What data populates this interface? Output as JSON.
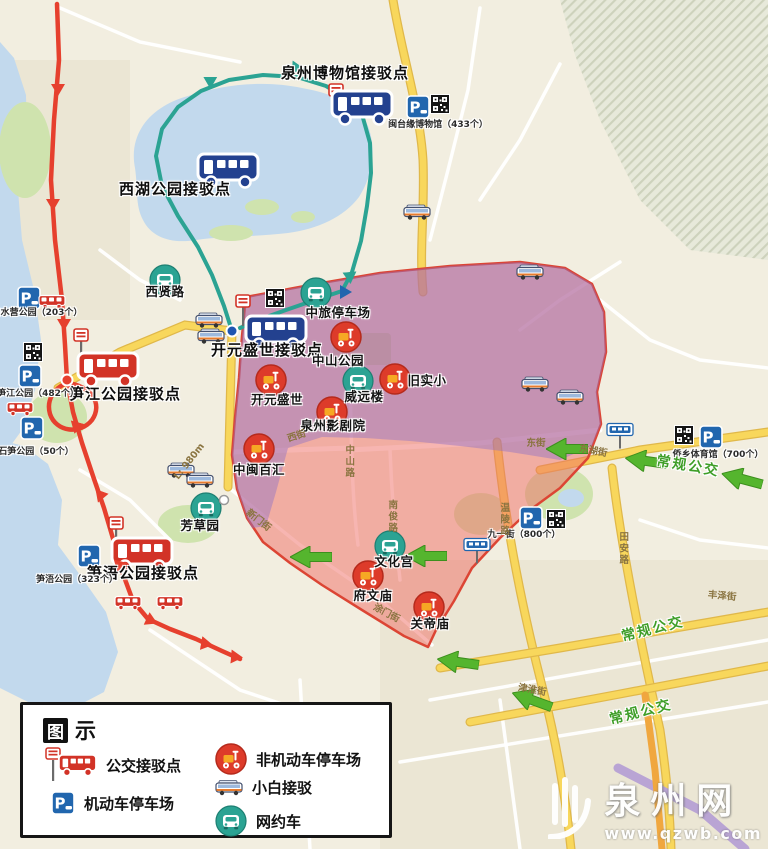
{
  "colors": {
    "land": "#f2eee0",
    "water": "#c2d9ed",
    "park": "#cfe3ae",
    "arterial": "#f8d75c",
    "arterial_casing": "#e0b84a",
    "zone_pink": "rgba(239,108,100,0.5)",
    "zone_border": "#dc4534",
    "zone_purple": "rgba(144,114,198,0.45)",
    "route_shuttle": "#2ba393",
    "route_red": "#e6402e",
    "bus_green": "#3f9e28",
    "parking_blue": "#2166ae",
    "scooter_red": "#dd3b2a",
    "netcar_teal": "#2ba393",
    "bus_blue": "#23418f",
    "bus_red": "#d23327",
    "arrow_green": "#55b52e"
  },
  "legend": {
    "title_box": "图",
    "title_rest": "示",
    "items": [
      {
        "label": "公交接驳点",
        "icon": "bus-shuttle-point"
      },
      {
        "label": "机动车停车场",
        "icon": "motor-parking"
      },
      {
        "label": "非机动车停车场",
        "icon": "non-motor-parking"
      },
      {
        "label": "小白接驳",
        "icon": "xiaobai-shuttle"
      },
      {
        "label": "网约车",
        "icon": "ride-hailing"
      }
    ]
  },
  "watermark": {
    "site": "泉州网",
    "url": "www.qzwb.com"
  },
  "map": {
    "labels": [
      {
        "text": "泉州博物馆接驳点",
        "x": 345,
        "y": 73,
        "cls": "pt"
      },
      {
        "text": "西湖公园接驳点",
        "x": 175,
        "y": 189,
        "cls": "pt"
      },
      {
        "text": "开元盛世接驳点",
        "x": 267,
        "y": 350,
        "cls": "pt"
      },
      {
        "text": "笋江公园接驳点",
        "x": 125,
        "y": 394,
        "cls": "pt"
      },
      {
        "text": "笋浯公园接驳点",
        "x": 143,
        "y": 573,
        "cls": "pt"
      },
      {
        "text": "中旅停车场",
        "x": 338,
        "y": 313,
        "cls": "poi"
      },
      {
        "text": "中山公园",
        "x": 338,
        "y": 361,
        "cls": "poi"
      },
      {
        "text": "旧实小",
        "x": 427,
        "y": 381,
        "cls": "poi"
      },
      {
        "text": "威远楼",
        "x": 364,
        "y": 397,
        "cls": "poi"
      },
      {
        "text": "开元盛世",
        "x": 277,
        "y": 400,
        "cls": "poi"
      },
      {
        "text": "泉州影剧院",
        "x": 333,
        "y": 426,
        "cls": "poi"
      },
      {
        "text": "中闽百汇",
        "x": 259,
        "y": 470,
        "cls": "poi"
      },
      {
        "text": "芳草园",
        "x": 200,
        "y": 526,
        "cls": "poi"
      },
      {
        "text": "文化宫",
        "x": 394,
        "y": 562,
        "cls": "poi"
      },
      {
        "text": "府文庙",
        "x": 373,
        "y": 596,
        "cls": "poi"
      },
      {
        "text": "关帝庙",
        "x": 430,
        "y": 624,
        "cls": "poi"
      },
      {
        "text": "西贤路",
        "x": 165,
        "y": 292,
        "cls": "poi"
      },
      {
        "text": "闽台缘博物馆（433个）",
        "x": 438,
        "y": 126,
        "cls": "park-lbl"
      },
      {
        "text": "白水营公园（203个）",
        "x": 37,
        "y": 314,
        "cls": "park-lbl"
      },
      {
        "text": "笋江公园（482个）",
        "x": 38,
        "y": 395,
        "cls": "park-lbl"
      },
      {
        "text": "石笋公园（50个）",
        "x": 36,
        "y": 453,
        "cls": "park-lbl"
      },
      {
        "text": "笋浯公园（323个）",
        "x": 77,
        "y": 581,
        "cls": "park-lbl"
      },
      {
        "text": "九一街（800个）",
        "x": 524,
        "y": 536,
        "cls": "park-lbl"
      },
      {
        "text": "侨乡体育馆（700个）",
        "x": 718,
        "y": 456,
        "cls": "park-lbl"
      },
      {
        "text": "西街",
        "x": 297,
        "y": 437,
        "cls": "road",
        "rot": -18
      },
      {
        "text": "东街",
        "x": 536,
        "y": 444,
        "cls": "road"
      },
      {
        "text": "东湖街",
        "x": 593,
        "y": 452,
        "cls": "road",
        "rot": 10
      },
      {
        "text": "津淮街",
        "x": 532,
        "y": 691,
        "cls": "road",
        "rot": 10
      },
      {
        "text": "丰泽街",
        "x": 722,
        "y": 597,
        "cls": "road",
        "rot": 5
      },
      {
        "text": "新门街",
        "x": 258,
        "y": 521,
        "cls": "road",
        "rot": 38
      },
      {
        "text": "涂门街",
        "x": 386,
        "y": 614,
        "cls": "road",
        "rot": 28
      },
      {
        "text": "L: 980m",
        "x": 190,
        "y": 462,
        "cls": "road",
        "rot": -52
      },
      {
        "text": "中山路",
        "x": 348,
        "y": 462,
        "cls": "roadv"
      },
      {
        "text": "南俊路",
        "x": 391,
        "y": 517,
        "cls": "roadv"
      },
      {
        "text": "温陵路",
        "x": 503,
        "y": 520,
        "cls": "roadv"
      },
      {
        "text": "田安路",
        "x": 622,
        "y": 549,
        "cls": "roadv"
      },
      {
        "text": "常规公交",
        "x": 688,
        "y": 467,
        "cls": "buslbl",
        "rot": 10
      },
      {
        "text": "常规公交",
        "x": 653,
        "y": 630,
        "cls": "buslbl",
        "rot": -14
      },
      {
        "text": "常规公交",
        "x": 641,
        "y": 713,
        "cls": "buslbl",
        "rot": -14
      }
    ],
    "markers": [
      {
        "t": "busstop",
        "x": 336,
        "y": 100
      },
      {
        "t": "bus_blue",
        "x": 362,
        "y": 107
      },
      {
        "t": "bus_blue",
        "x": 228,
        "y": 170
      },
      {
        "t": "busstop",
        "x": 243,
        "y": 311
      },
      {
        "t": "bus_blue",
        "x": 276,
        "y": 332
      },
      {
        "t": "dot_blue",
        "x": 232,
        "y": 331
      },
      {
        "t": "busstop",
        "x": 81,
        "y": 345
      },
      {
        "t": "bus_red",
        "x": 108,
        "y": 369
      },
      {
        "t": "dot_red",
        "x": 67,
        "y": 380
      },
      {
        "t": "busstop",
        "x": 116,
        "y": 533
      },
      {
        "t": "bus_red",
        "x": 142,
        "y": 554
      },
      {
        "t": "busstop_bus",
        "x": 620,
        "y": 436
      },
      {
        "t": "busstop_bus",
        "x": 477,
        "y": 551
      },
      {
        "t": "parking",
        "x": 418,
        "y": 107
      },
      {
        "t": "qr",
        "x": 440,
        "y": 104
      },
      {
        "t": "parking",
        "x": 29,
        "y": 298
      },
      {
        "t": "qr",
        "x": 33,
        "y": 352
      },
      {
        "t": "parking",
        "x": 30,
        "y": 376
      },
      {
        "t": "parking",
        "x": 32,
        "y": 428
      },
      {
        "t": "parking",
        "x": 89,
        "y": 556
      },
      {
        "t": "parking",
        "x": 531,
        "y": 518
      },
      {
        "t": "qr",
        "x": 556,
        "y": 519
      },
      {
        "t": "parking",
        "x": 711,
        "y": 437
      },
      {
        "t": "qr",
        "x": 684,
        "y": 435
      },
      {
        "t": "qr",
        "x": 275,
        "y": 298
      },
      {
        "t": "minibus",
        "x": 209,
        "y": 320
      },
      {
        "t": "minibus",
        "x": 211,
        "y": 336
      },
      {
        "t": "minibus",
        "x": 181,
        "y": 470
      },
      {
        "t": "minibus",
        "x": 200,
        "y": 480
      },
      {
        "t": "minibus",
        "x": 417,
        "y": 212
      },
      {
        "t": "minibus",
        "x": 530,
        "y": 272
      },
      {
        "t": "minibus",
        "x": 535,
        "y": 384
      },
      {
        "t": "minibus",
        "x": 570,
        "y": 397
      },
      {
        "t": "minired",
        "x": 52,
        "y": 301
      },
      {
        "t": "minired",
        "x": 20,
        "y": 408
      },
      {
        "t": "minired",
        "x": 128,
        "y": 602
      },
      {
        "t": "minired",
        "x": 170,
        "y": 602
      },
      {
        "t": "scooter",
        "x": 346,
        "y": 337
      },
      {
        "t": "scooter",
        "x": 271,
        "y": 380
      },
      {
        "t": "scooter",
        "x": 395,
        "y": 379
      },
      {
        "t": "scooter",
        "x": 332,
        "y": 412
      },
      {
        "t": "scooter",
        "x": 259,
        "y": 449
      },
      {
        "t": "scooter",
        "x": 368,
        "y": 576
      },
      {
        "t": "scooter",
        "x": 429,
        "y": 607
      },
      {
        "t": "netcar",
        "x": 165,
        "y": 280
      },
      {
        "t": "netcar",
        "x": 316,
        "y": 293
      },
      {
        "t": "netcar",
        "x": 358,
        "y": 381
      },
      {
        "t": "netcar",
        "x": 390,
        "y": 546
      },
      {
        "t": "netcar",
        "x": 206,
        "y": 508
      },
      {
        "t": "dot_white",
        "x": 224,
        "y": 500
      },
      {
        "t": "arrow",
        "x": 567,
        "y": 449,
        "rot": 0
      },
      {
        "t": "arrow",
        "x": 646,
        "y": 461,
        "rot": 8
      },
      {
        "t": "arrow",
        "x": 742,
        "y": 479,
        "rot": 15
      },
      {
        "t": "arrow",
        "x": 311,
        "y": 557,
        "rot": 0
      },
      {
        "t": "arrow",
        "x": 426,
        "y": 556,
        "rot": 0
      },
      {
        "t": "arrow",
        "x": 458,
        "y": 662,
        "rot": 8
      },
      {
        "t": "arrow",
        "x": 532,
        "y": 700,
        "rot": 20
      },
      {
        "t": "tri",
        "x": 212,
        "y": 80,
        "rot": 60,
        "c": "#2ba393"
      },
      {
        "t": "tri",
        "x": 298,
        "y": 68,
        "rot": 95,
        "c": "#2ba393"
      },
      {
        "t": "tri",
        "x": 350,
        "y": 278,
        "rot": 175,
        "c": "#2ba393"
      },
      {
        "t": "tri",
        "x": 346,
        "y": 292,
        "rot": 90,
        "c": "#2166ae"
      },
      {
        "t": "tri",
        "x": 58,
        "y": 90,
        "rot": 180,
        "c": "#e6402e"
      },
      {
        "t": "tri",
        "x": 53,
        "y": 205,
        "rot": 180,
        "c": "#e6402e"
      },
      {
        "t": "tri",
        "x": 64,
        "y": 325,
        "rot": 180,
        "c": "#e6402e"
      },
      {
        "t": "tri",
        "x": 76,
        "y": 428,
        "rot": 195,
        "c": "#e6402e"
      },
      {
        "t": "tri",
        "x": 100,
        "y": 497,
        "rot": 200,
        "c": "#e6402e"
      },
      {
        "t": "tri",
        "x": 119,
        "y": 567,
        "rot": 195,
        "c": "#e6402e"
      },
      {
        "t": "tri",
        "x": 152,
        "y": 621,
        "rot": 115,
        "c": "#e6402e"
      },
      {
        "t": "tri",
        "x": 207,
        "y": 644,
        "rot": 100,
        "c": "#e6402e"
      },
      {
        "t": "tri",
        "x": 237,
        "y": 657,
        "rot": 95,
        "c": "#e6402e"
      }
    ]
  }
}
